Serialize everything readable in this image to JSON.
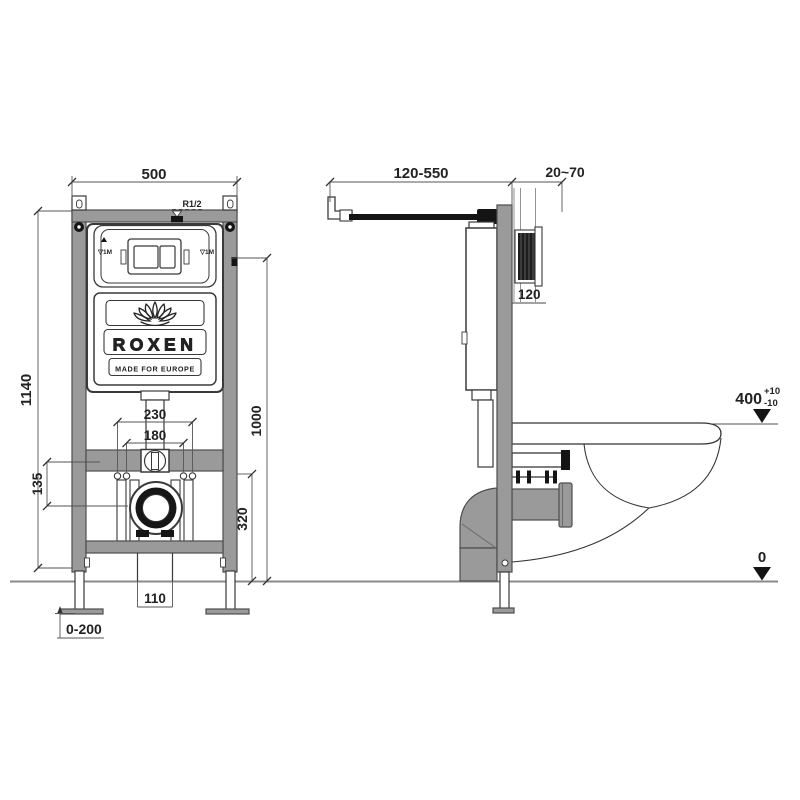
{
  "front_view": {
    "dim_width": "500",
    "dim_height": "1140",
    "dim_holes_outer": "230",
    "dim_holes_inner": "180",
    "dim_offset": "135",
    "dim_plate_height": "1000",
    "dim_outlet_height": "320",
    "dim_outlet_width": "110",
    "dim_foot_adjust": "0-200",
    "label_inlet": "R1/2",
    "label_level_left": "▽1M",
    "label_level_right": "▽1M",
    "brand_name": "ROXEN",
    "brand_tagline": "MADE FOR EUROPE"
  },
  "side_view": {
    "dim_arm_range": "120-550",
    "dim_wall_thickness": "20~70",
    "dim_shaft_depth": "120",
    "dim_bowl_height": "400",
    "dim_bowl_tol_plus": "+10",
    "dim_bowl_tol_minus": "-10",
    "dim_floor_level": "0"
  },
  "colors": {
    "steel": "#9a9a9a",
    "outline": "#3a3a3a",
    "dimension": "#555555",
    "background": "#ffffff"
  }
}
